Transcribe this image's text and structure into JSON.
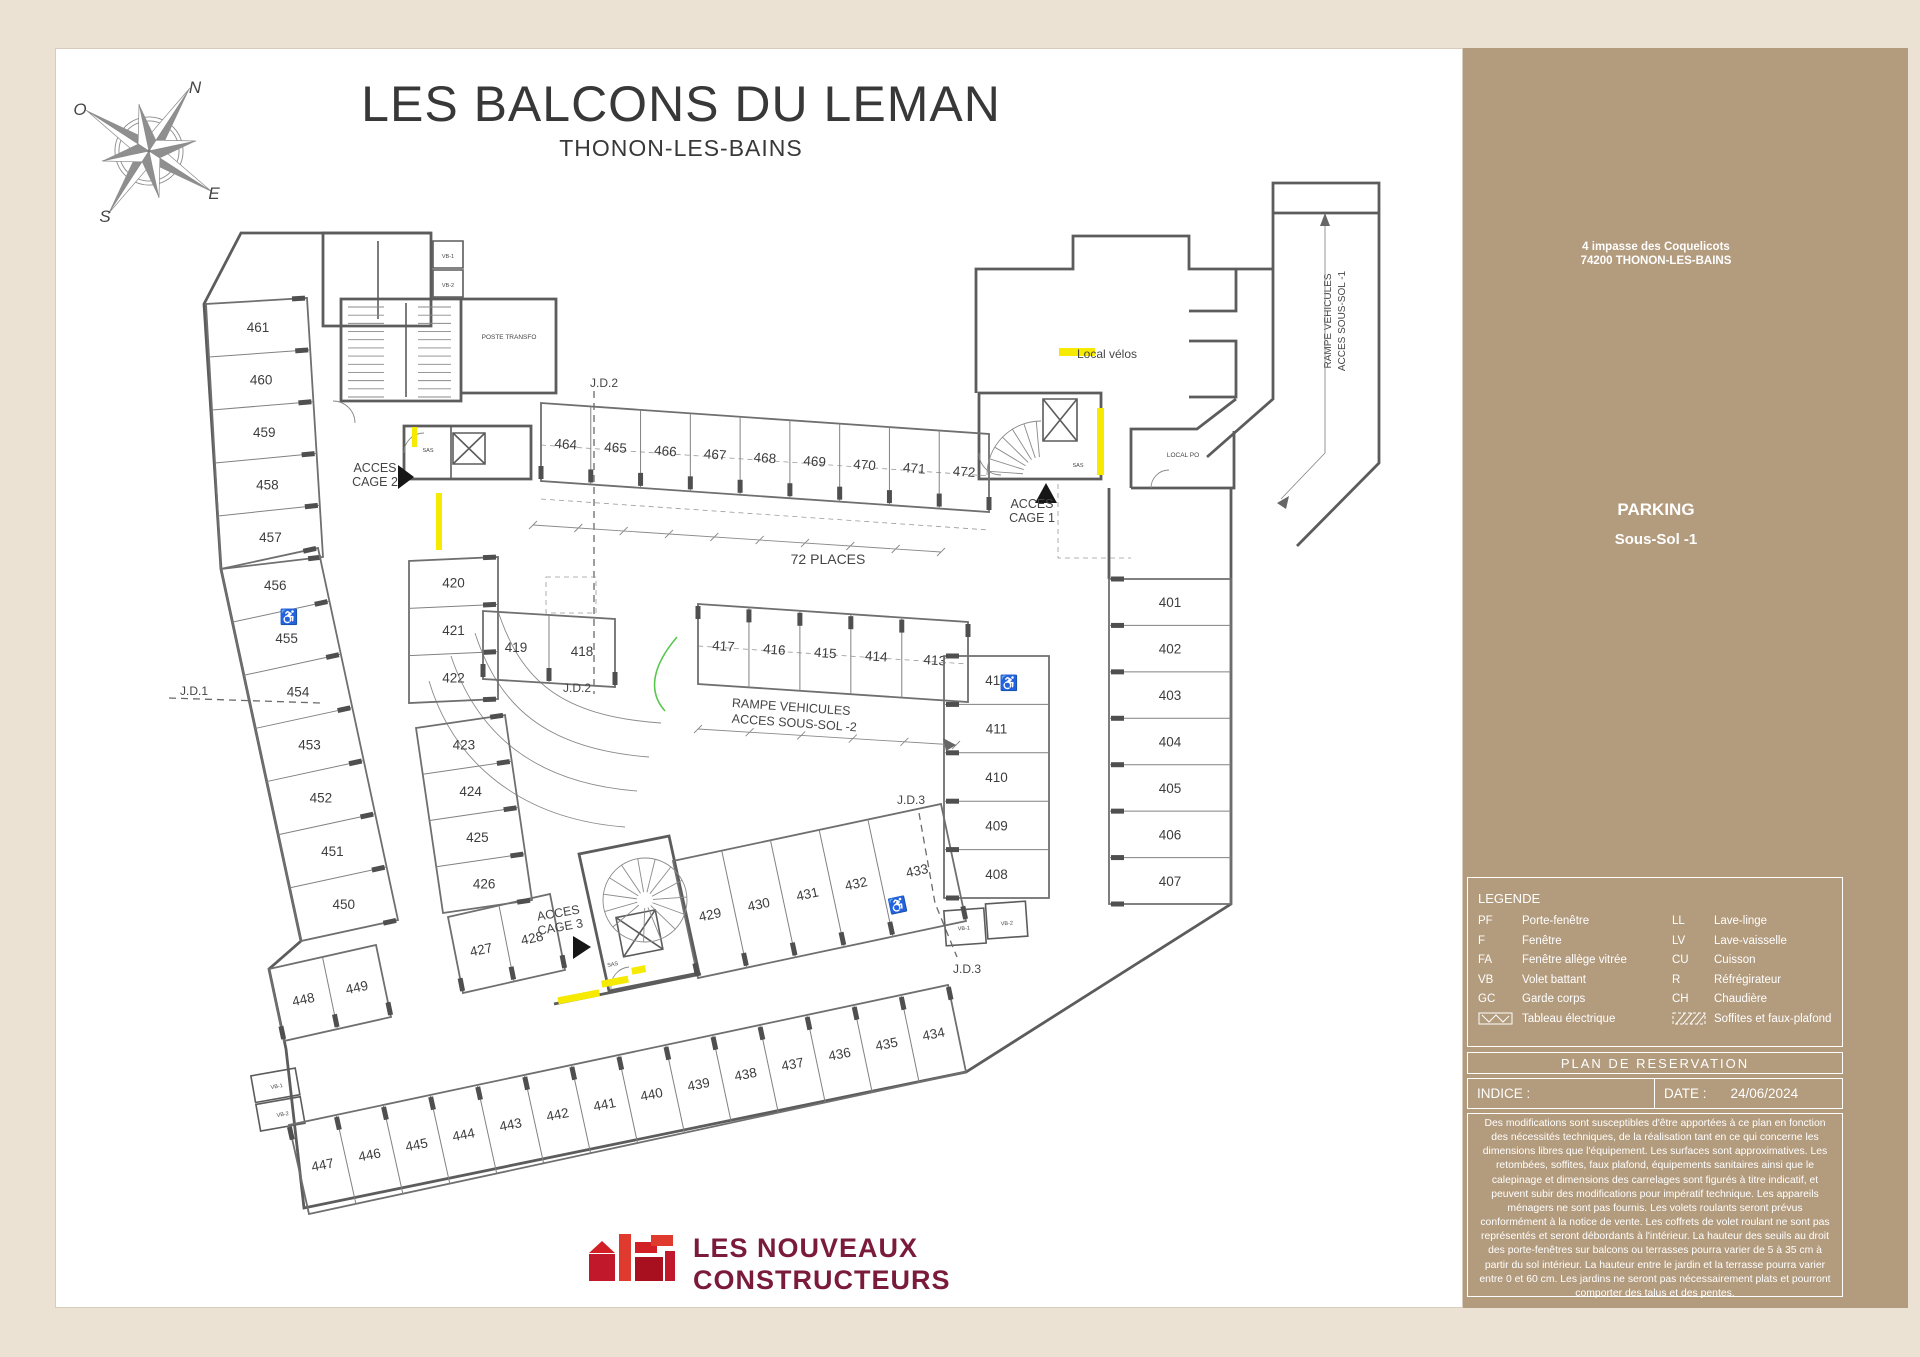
{
  "title": {
    "main": "LES BALCONS DU LEMAN",
    "subtitle": "THONON-LES-BAINS"
  },
  "logo": {
    "line1": "LES NOUVEAUX",
    "line2": "CONSTRUCTEURS"
  },
  "colors": {
    "panel": "#b39b7d",
    "highlight": "#f6ea00",
    "logo_red": "#d21f26",
    "logo_text": "#7a1b3c"
  },
  "sidebar": {
    "address_line1": "4 impasse des Coquelicots",
    "address_line2": "74200 THONON-LES-BAINS",
    "floor_title": "PARKING",
    "floor_subtitle": "Sous-Sol -1",
    "legend": {
      "title": "LEGENDE",
      "items_left": [
        {
          "code": "PF",
          "label": "Porte-fenêtre"
        },
        {
          "code": "F",
          "label": "Fenêtre"
        },
        {
          "code": "FA",
          "label": "Fenêtre allège vitrée"
        },
        {
          "code": "VB",
          "label": "Volet battant"
        },
        {
          "code": "GC",
          "label": "Garde corps"
        }
      ],
      "items_right": [
        {
          "code": "LL",
          "label": "Lave-linge"
        },
        {
          "code": "LV",
          "label": "Lave-vaisselle"
        },
        {
          "code": "CU",
          "label": "Cuisson"
        },
        {
          "code": "R",
          "label": "Réfrégirateur"
        },
        {
          "code": "CH",
          "label": "Chaudière"
        }
      ],
      "tableau_label": "Tableau électrique",
      "soffites_label": "Soffites et faux-plafond"
    },
    "plan_title": "PLAN DE RESERVATION",
    "indice_label": "INDICE :",
    "date_label": "DATE :",
    "date_value": "24/06/2024",
    "disclaimer": "Des modifications sont susceptibles d'être apportées à ce plan en fonction des nécessités techniques, de la réalisation tant en ce qui concerne les dimensions libres que l'équipement. Les surfaces sont approximatives. Les retombées, soffites, faux plafond, équipements sanitaires ainsi que le calepinage et dimensions des carrelages sont figurés à titre indicatif, et peuvent subir des modifications pour impératif technique. Les appareils ménagers ne sont pas fournis. Les volets roulants seront prévus conformément à la notice de vente. Les coffrets de volet roulant ne sont pas représentés et seront débordants à l'intérieur. La hauteur des seuils au droit des porte-fenêtres sur balcons ou terrasses pourra varier de 5 à 35 cm à partir du sol intérieur. La hauteur entre le jardin et la terrasse pourra varier entre 0 et 60 cm. Les jardins ne seront pas nécessairement plats et pourront comporter des talus et des pentes."
  },
  "plan": {
    "bands": {
      "left_top": [
        "461",
        "460",
        "459",
        "458",
        "457"
      ],
      "left_mid": [
        "456",
        "455",
        "454",
        "453",
        "452",
        "451",
        "450"
      ],
      "c448": [
        "448",
        "449"
      ],
      "k427": [
        "427",
        "428"
      ],
      "bottom": [
        "447",
        "446",
        "445",
        "444",
        "443",
        "442",
        "441",
        "440",
        "439",
        "438",
        "437",
        "436",
        "435",
        "434"
      ],
      "f429": [
        "429",
        "430",
        "431",
        "432",
        "433"
      ],
      "top": [
        "464",
        "465",
        "466",
        "467",
        "468",
        "469",
        "470",
        "471",
        "472"
      ],
      "h417": [
        "417",
        "416",
        "415",
        "414",
        "413"
      ],
      "i420": [
        "420",
        "421",
        "422"
      ],
      "j423": [
        "423",
        "424",
        "425",
        "426"
      ],
      "s418": [
        "419",
        "418"
      ],
      "l401": [
        "401",
        "402",
        "403",
        "404",
        "405",
        "406",
        "407"
      ],
      "m408": [
        "412",
        "411",
        "410",
        "409",
        "408"
      ]
    },
    "annotations": [
      {
        "text": "J.D.1",
        "x": 193,
        "y": 694,
        "size": 12
      },
      {
        "text": "J.D.2",
        "x": 603,
        "y": 386,
        "size": 12
      },
      {
        "text": "J.D.2",
        "x": 576,
        "y": 691,
        "size": 12
      },
      {
        "text": "J.D.3",
        "x": 910,
        "y": 803,
        "size": 12
      },
      {
        "text": "J.D.3",
        "x": 966,
        "y": 972,
        "size": 12
      },
      {
        "text": "72 PLACES",
        "x": 827,
        "y": 563,
        "size": 14
      },
      {
        "text": "RAMPE VEHICULES",
        "x": 790,
        "y": 710,
        "size": 12.5,
        "rot": 4
      },
      {
        "text": "ACCES SOUS-SOL -2",
        "x": 793,
        "y": 726,
        "size": 12.5,
        "rot": 4
      },
      {
        "text": "RAMPE VEHICULES",
        "x": 1330,
        "y": 320,
        "size": 10,
        "rot": -90
      },
      {
        "text": "ACCES SOUS-SOL -1",
        "x": 1344,
        "y": 320,
        "size": 10,
        "rot": -90
      },
      {
        "text": "ACCES",
        "x": 374,
        "y": 471,
        "size": 12.5
      },
      {
        "text": "CAGE 2",
        "x": 374,
        "y": 485,
        "size": 12.5
      },
      {
        "text": "ACCES",
        "x": 1031,
        "y": 507,
        "size": 12.5
      },
      {
        "text": "CAGE 1",
        "x": 1031,
        "y": 521,
        "size": 12.5
      },
      {
        "text": "ACCES",
        "x": 558,
        "y": 916,
        "size": 12.5,
        "rot": -10
      },
      {
        "text": "CAGE 3",
        "x": 560,
        "y": 930,
        "size": 12.5,
        "rot": -10
      },
      {
        "text": "Local vélos",
        "x": 1106,
        "y": 357,
        "size": 12,
        "anchor": "start"
      },
      {
        "text": "POSTE TRANSFO",
        "x": 508,
        "y": 338,
        "size": 6.5
      },
      {
        "text": "LOCAL PO",
        "x": 1182,
        "y": 456,
        "size": 6.5
      },
      {
        "text": "SAS",
        "x": 427,
        "y": 451,
        "size": 5.5
      },
      {
        "text": "SAS",
        "x": 1077,
        "y": 466,
        "size": 5.5
      },
      {
        "text": "SAS",
        "x": 612,
        "y": 965,
        "size": 5.5,
        "rot": -10
      },
      {
        "text": "VB-1",
        "x": 447,
        "y": 257,
        "size": 5.5
      },
      {
        "text": "VB-2",
        "x": 447,
        "y": 286,
        "size": 5.5
      },
      {
        "text": "VB-1",
        "x": 276,
        "y": 1087,
        "size": 5.5,
        "rot": -10
      },
      {
        "text": "VB-2",
        "x": 282,
        "y": 1115,
        "size": 5.5,
        "rot": -10
      },
      {
        "text": "VB-1",
        "x": 963,
        "y": 929,
        "size": 5.5,
        "rot": -4
      },
      {
        "text": "VB-2",
        "x": 1006,
        "y": 924,
        "size": 5.5,
        "rot": -4
      },
      {
        "text": "♿",
        "x": 288,
        "y": 621,
        "size": 15
      },
      {
        "text": "♿",
        "x": 1008,
        "y": 687,
        "size": 15
      },
      {
        "text": "♿",
        "x": 898,
        "y": 909,
        "size": 15,
        "rot": -12
      },
      {
        "text": "N",
        "x": 194,
        "y": 92,
        "size": 17,
        "serif": true
      },
      {
        "text": "O",
        "x": 79,
        "y": 114,
        "size": 17,
        "serif": true
      },
      {
        "text": "E",
        "x": 213,
        "y": 198,
        "size": 17,
        "serif": true
      },
      {
        "text": "S",
        "x": 104,
        "y": 221,
        "size": 17,
        "serif": true
      }
    ]
  }
}
